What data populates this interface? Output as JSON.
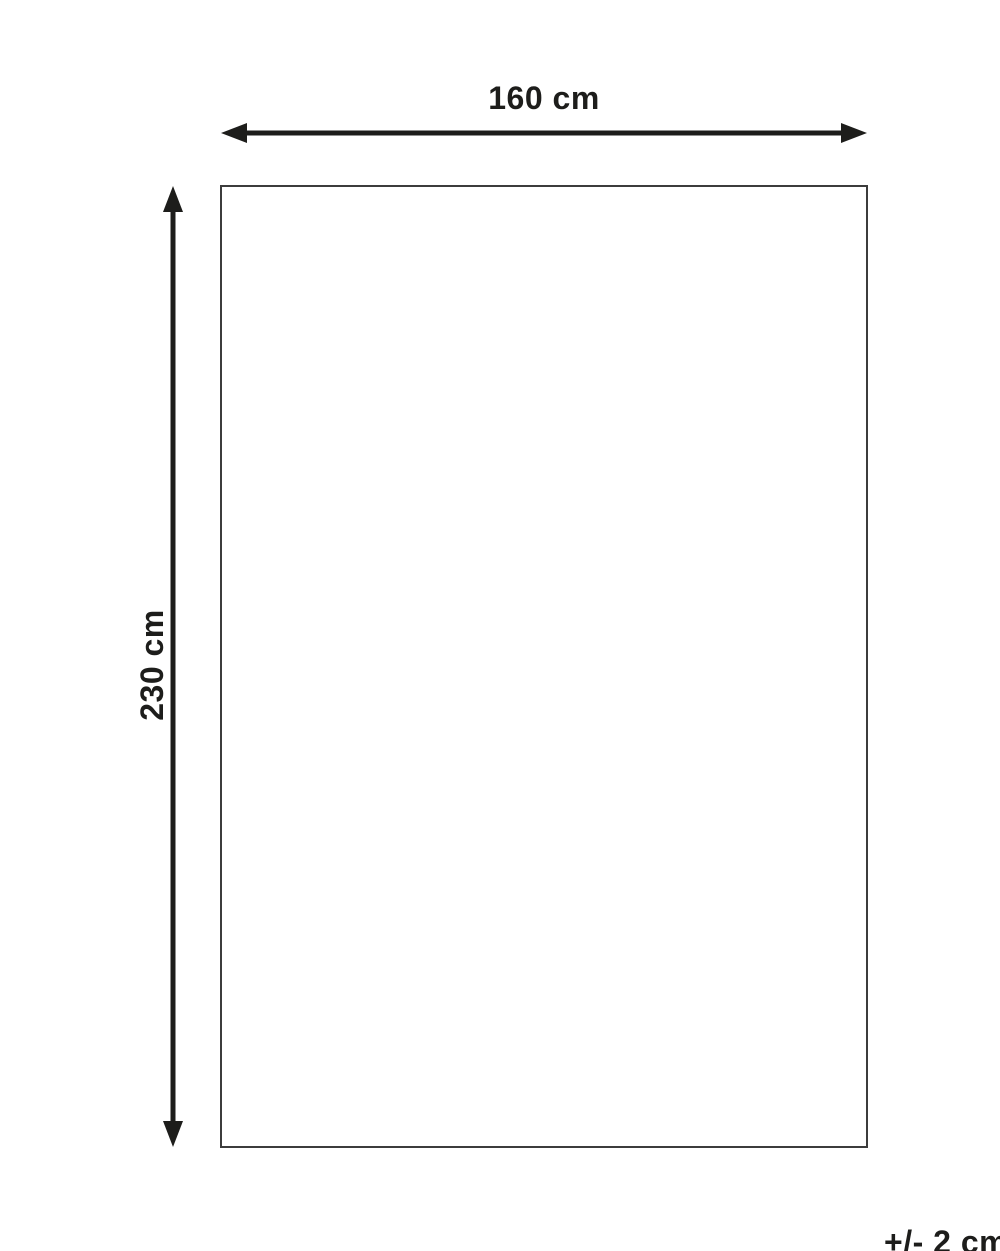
{
  "diagram": {
    "type": "dimension-diagram",
    "width_label": "160 cm",
    "height_label": "230 cm",
    "tolerance_label": "+/- 2 cm",
    "width_value_cm": 160,
    "height_value_cm": 230,
    "tolerance_value_cm": 2,
    "colors": {
      "background": "#ffffff",
      "arrow": "#1d1d1b",
      "outline": "#3c3c3c",
      "text": "#1d1d1b"
    }
  }
}
